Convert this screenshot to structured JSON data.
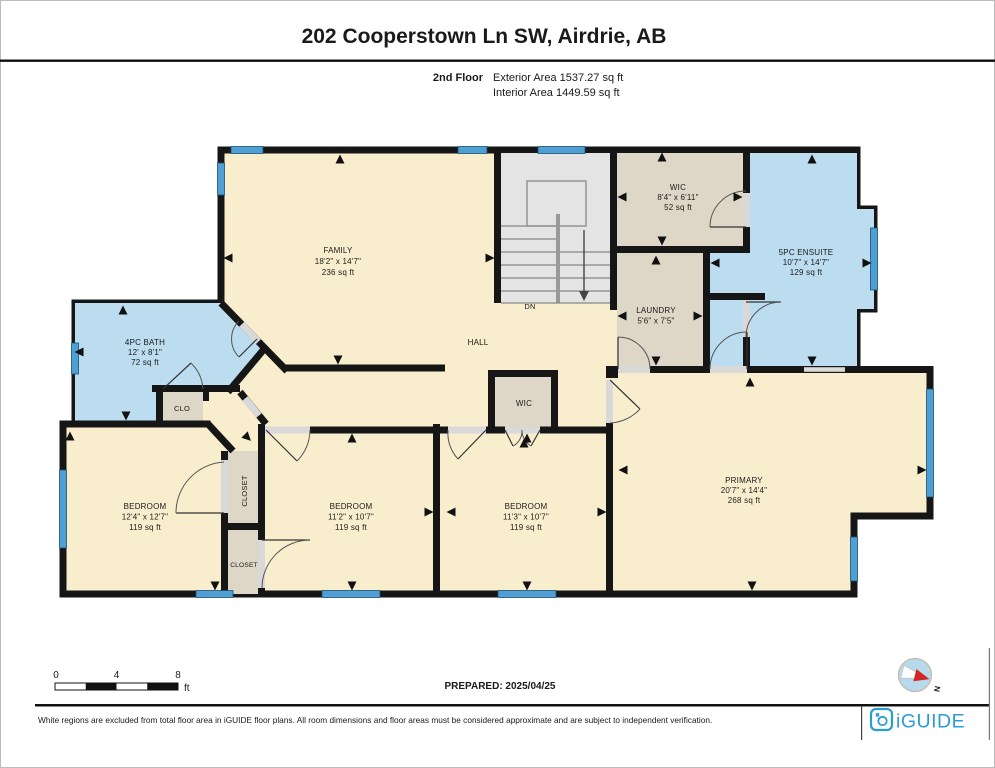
{
  "header": {
    "title": "202 Cooperstown Ln SW, Airdrie, AB",
    "floor": "2nd Floor",
    "exterior": "Exterior Area 1537.27 sq ft",
    "interior": "Interior Area 1449.59 sq ft"
  },
  "rooms": [
    {
      "id": "family",
      "name": "FAMILY",
      "dims": "18'2\" x 14'7\"",
      "area": "236 sq ft"
    },
    {
      "id": "wic-top",
      "name": "WIC",
      "dims": "8'4\" x 6'11\"",
      "area": "52 sq ft"
    },
    {
      "id": "ensuite",
      "name": "5PC ENSUITE",
      "dims": "10'7\" x 14'7\"",
      "area": "129 sq ft"
    },
    {
      "id": "laundry",
      "name": "LAUNDRY",
      "dims": "5'6\" x 7'5\"",
      "area": ""
    },
    {
      "id": "bath",
      "name": "4PC BATH",
      "dims": "12' x 8'1\"",
      "area": "72 sq ft"
    },
    {
      "id": "bedroom-left",
      "name": "BEDROOM",
      "dims": "12'4\" x 12'7\"",
      "area": "119 sq ft"
    },
    {
      "id": "bedroom-mid",
      "name": "BEDROOM",
      "dims": "11'2\" x 10'7\"",
      "area": "119 sq ft"
    },
    {
      "id": "bedroom-right",
      "name": "BEDROOM",
      "dims": "11'3\" x 10'7\"",
      "area": "119 sq ft"
    },
    {
      "id": "primary",
      "name": "PRIMARY",
      "dims": "20'7\" x 14'4\"",
      "area": "268 sq ft"
    }
  ],
  "labels": {
    "hall": "HALL",
    "dn": "DN",
    "clo": "CLO",
    "wic_small": "WIC",
    "closet_upper": "CLOSET",
    "closet_lower": "CLOSET"
  },
  "scale": {
    "n0": "0",
    "n4": "4",
    "n8": "8",
    "unit": "ft"
  },
  "prepared": "PREPARED: 2025/04/25",
  "compass": {
    "north_label": "N"
  },
  "footer": {
    "disclaimer": "White regions are excluded from total floor area in iGUIDE floor plans. All room dimensions and floor areas must be considered approximate and are subject to independent verification.",
    "logo_text": "iGUIDE"
  },
  "colors": {
    "wall": "#161616",
    "floor": "#f8eecd",
    "wet_room": "#bcdcf0",
    "closet_room": "#ded6c6",
    "stairs": "#e4e4e4",
    "window": "#4f9fd4",
    "logo_blue": "#2b9cd8",
    "compass_red": "#d42525"
  }
}
